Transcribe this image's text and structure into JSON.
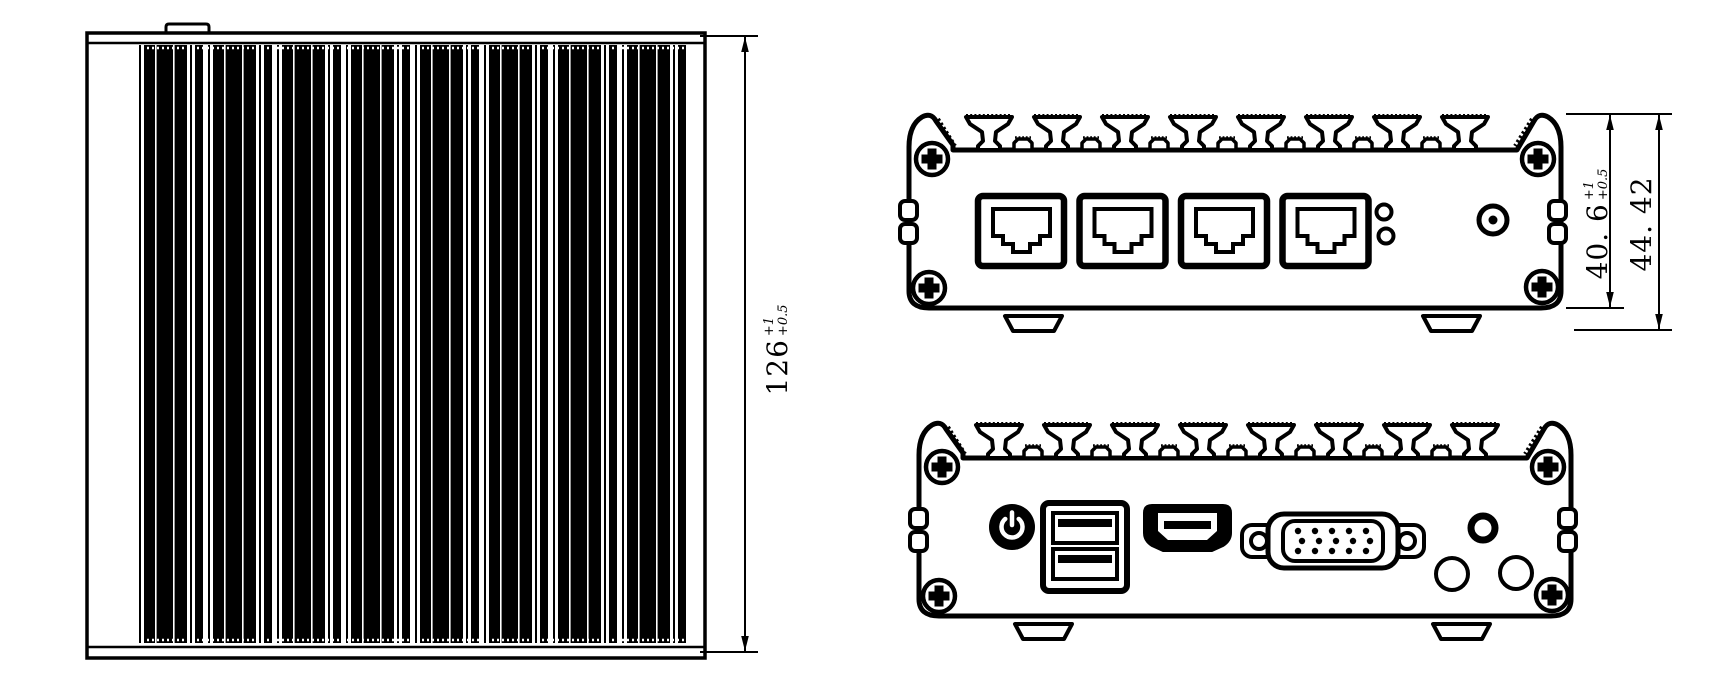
{
  "colors": {
    "line": "#000000",
    "background": "#ffffff"
  },
  "dimensions": {
    "left_height": {
      "value": "126",
      "tol_top": "+1",
      "tol_bottom": "+0.5"
    },
    "body_height": {
      "value": "40. 6",
      "tol_top": "+1",
      "tol_bottom": "+0.5"
    },
    "overall_height": {
      "value": "44. 42"
    }
  },
  "views": {
    "top": {
      "name": "top-view-heatsink-fins",
      "fin_count": 8
    },
    "front": {
      "name": "front-panel",
      "connectors": [
        "rj45-port",
        "rj45-port",
        "rj45-port",
        "rj45-port",
        "led-indicator",
        "led-indicator",
        "dc-jack"
      ]
    },
    "rear": {
      "name": "rear-panel",
      "connectors": [
        "power-button",
        "usb-dual-port",
        "hdmi-port",
        "vga-port",
        "audio-jack",
        "antenna-hole",
        "antenna-hole"
      ]
    }
  }
}
